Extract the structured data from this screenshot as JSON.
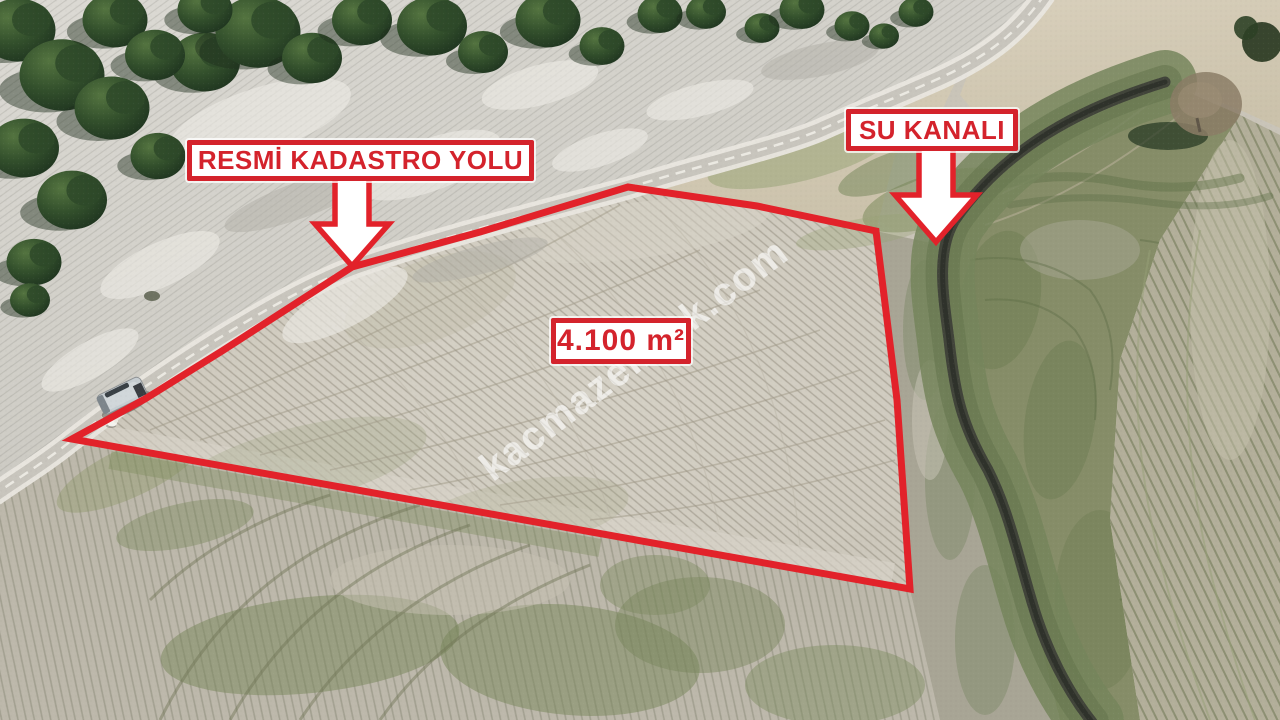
{
  "overlay": {
    "road_label": {
      "text": "RESMİ KADASTRO YOLU"
    },
    "canal_label": {
      "text": "SU KANALI"
    },
    "area_label": {
      "text": "4.100 m²"
    },
    "watermark": {
      "text": "kacmazemlak.com"
    }
  },
  "colors": {
    "annotation_red": "#d4232c",
    "line_red": "#e2222a",
    "label_background": "#ffffff",
    "watermark_white": "#ffffff"
  }
}
